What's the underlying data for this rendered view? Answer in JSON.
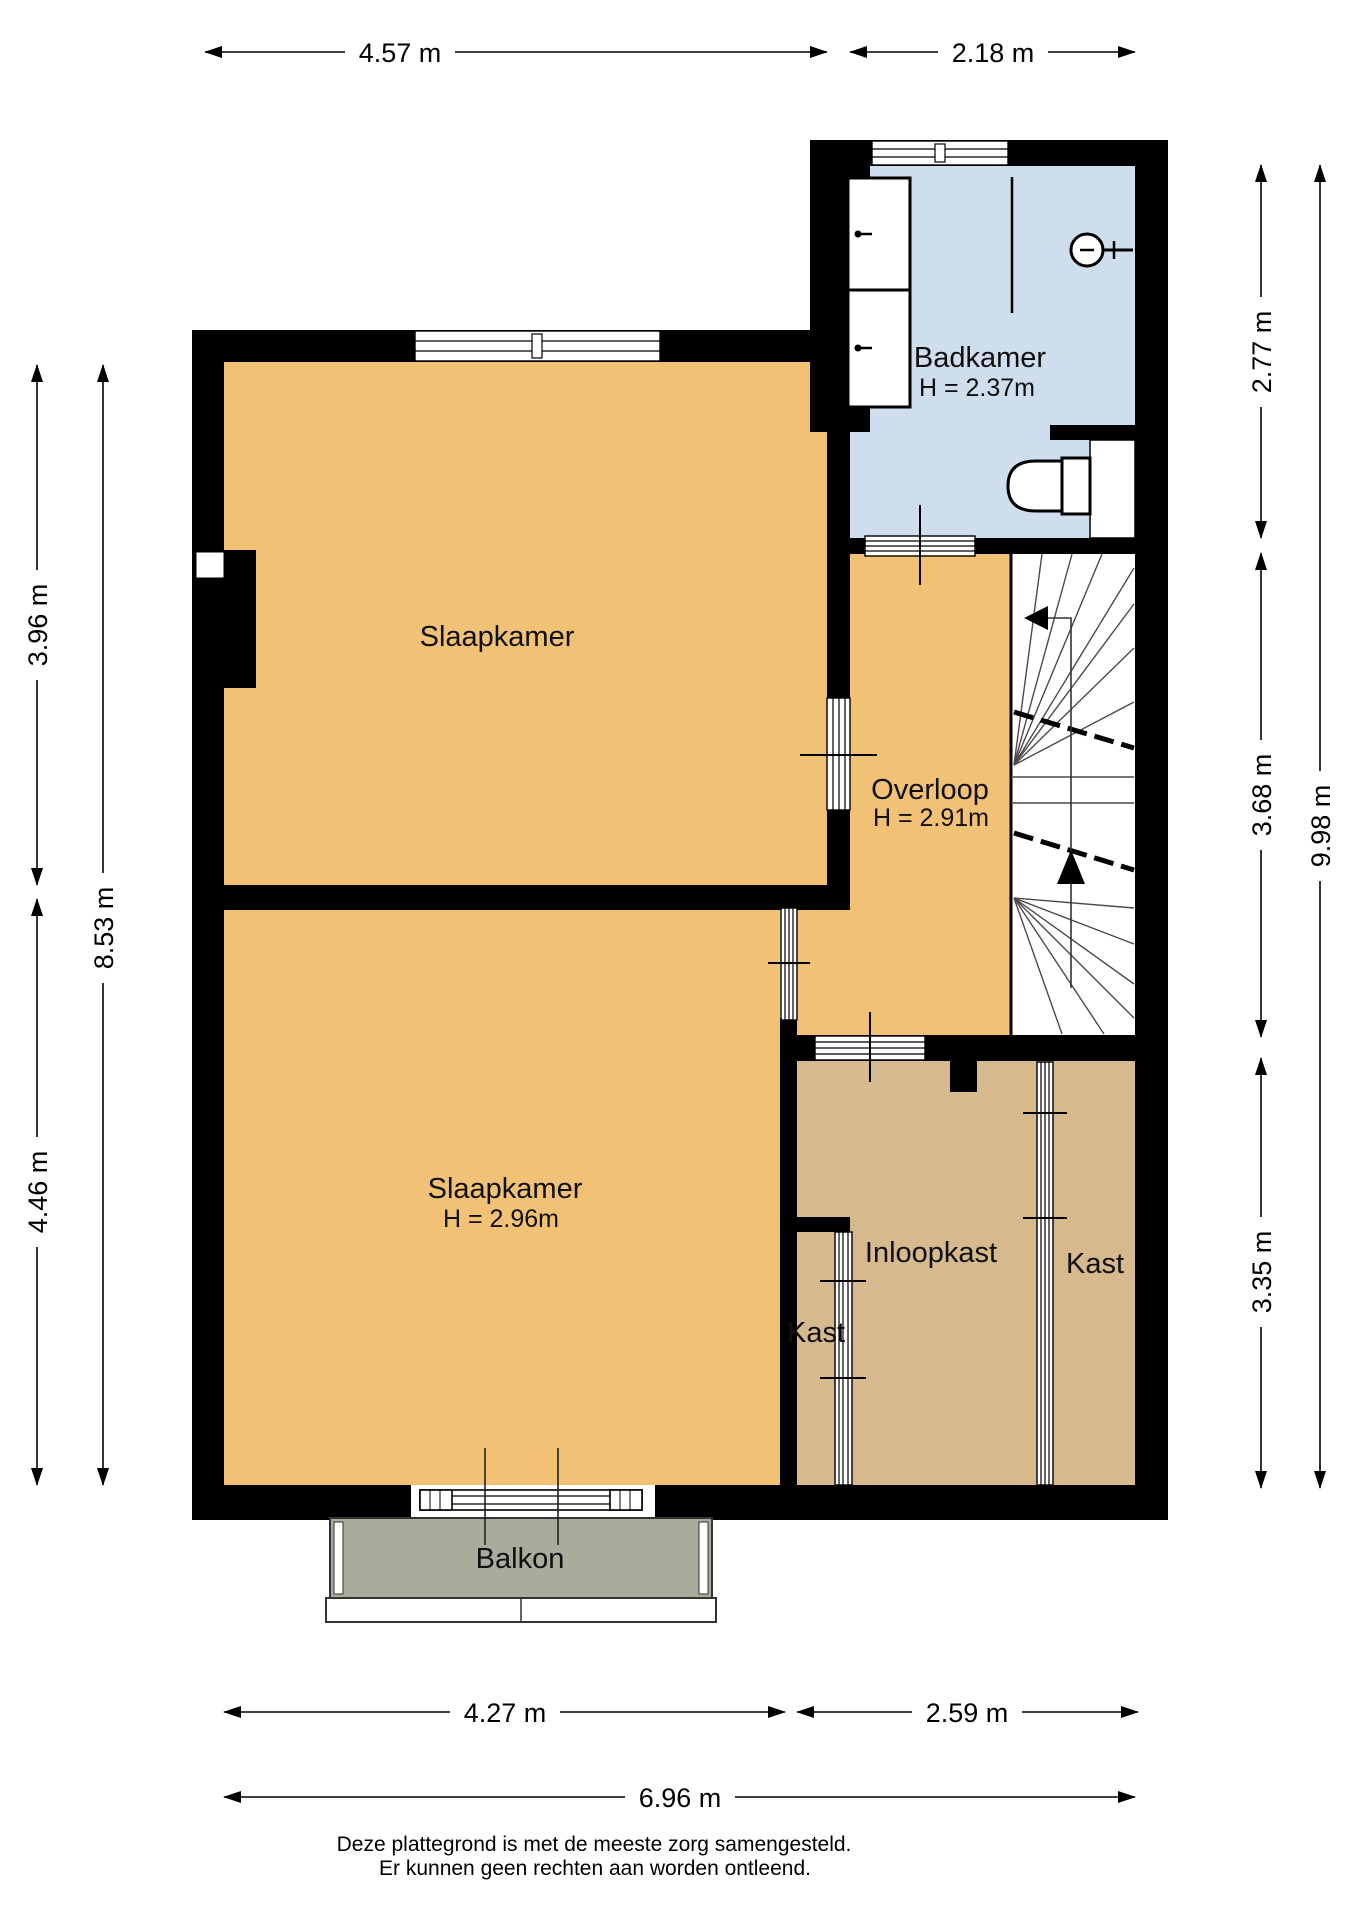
{
  "plan": {
    "type": "floorplan-verdieping",
    "units": "m"
  },
  "colors": {
    "room_orange": "#F1C175",
    "closet_tan": "#D6B98C",
    "bathroom_blue": "#CFDEEC",
    "balcony_gray": "#A9AC9B",
    "wall_black": "#000000"
  },
  "rooms": {
    "badkamer": {
      "label": "Badkamer",
      "height": "H = 2.37m"
    },
    "overloop": {
      "label": "Overloop",
      "height": "H = 2.91m"
    },
    "slaapkamer_boven": {
      "label": "Slaapkamer"
    },
    "slaapkamer_onder": {
      "label": "Slaapkamer",
      "height": "H = 2.96m"
    },
    "inloopkast": {
      "label": "Inloopkast"
    },
    "kast_klein": {
      "label": "Kast"
    },
    "kast_rechts": {
      "label": "Kast"
    },
    "balkon": {
      "label": "Balkon"
    }
  },
  "dimensions": {
    "top": [
      {
        "label": "4.57 m"
      },
      {
        "label": "2.18 m"
      }
    ],
    "bottom": [
      {
        "label": "4.27 m"
      },
      {
        "label": "2.59 m"
      },
      {
        "label": "6.96 m"
      }
    ],
    "left": [
      {
        "label": "3.96 m"
      },
      {
        "label": "4.46 m"
      },
      {
        "label": "8.53 m"
      }
    ],
    "right": [
      {
        "label": "2.77 m"
      },
      {
        "label": "3.68 m"
      },
      {
        "label": "3.35 m"
      },
      {
        "label": "9.98 m"
      }
    ]
  },
  "footer": {
    "line1": "Deze plattegrond is met de meeste zorg samengesteld.",
    "line2": "Er kunnen geen rechten aan worden ontleend."
  }
}
